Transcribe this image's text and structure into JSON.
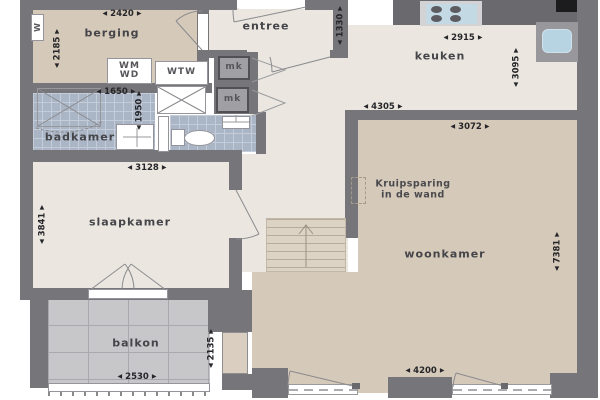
{
  "arrows": {
    "left": "◀",
    "right": "▶"
  },
  "rooms": {
    "berging": {
      "label": "berging",
      "width": "2420",
      "height": "2185"
    },
    "entree": {
      "label": "entree",
      "height": "1330"
    },
    "keuken": {
      "label": "keuken",
      "width": "2915",
      "height": "3095"
    },
    "hal": {
      "width": "4305"
    },
    "badkamer": {
      "label": "badkamer",
      "width": "1650",
      "height": "1950"
    },
    "slaapkamer": {
      "label": "slaapkamer",
      "width": "3128",
      "height": "3841"
    },
    "woonkamer": {
      "label": "woonkamer",
      "width_top": "3072",
      "height": "7381",
      "width_bottom": "4200"
    },
    "balkon": {
      "label": "balkon",
      "width": "2530",
      "height": "2135"
    }
  },
  "fixtures": {
    "water_meter": "W",
    "washer": "WM",
    "dryer": "WD",
    "heat_recovery": "WTW",
    "meter_cupboard": "mk"
  },
  "annotations": {
    "kruipsparing": "Kruipsparing\nin de wand"
  },
  "colors": {
    "wall": "#76767a",
    "floor_beige": "#d5c9b9",
    "floor_cream": "#ebe7e0",
    "tile_blue": "#aab6c6",
    "balcony_tile": "#c7c7ca",
    "sink_blue": "#b6d4e2",
    "counter_dark": "#6a6a6e",
    "accent_black": "#1c1c1e"
  }
}
